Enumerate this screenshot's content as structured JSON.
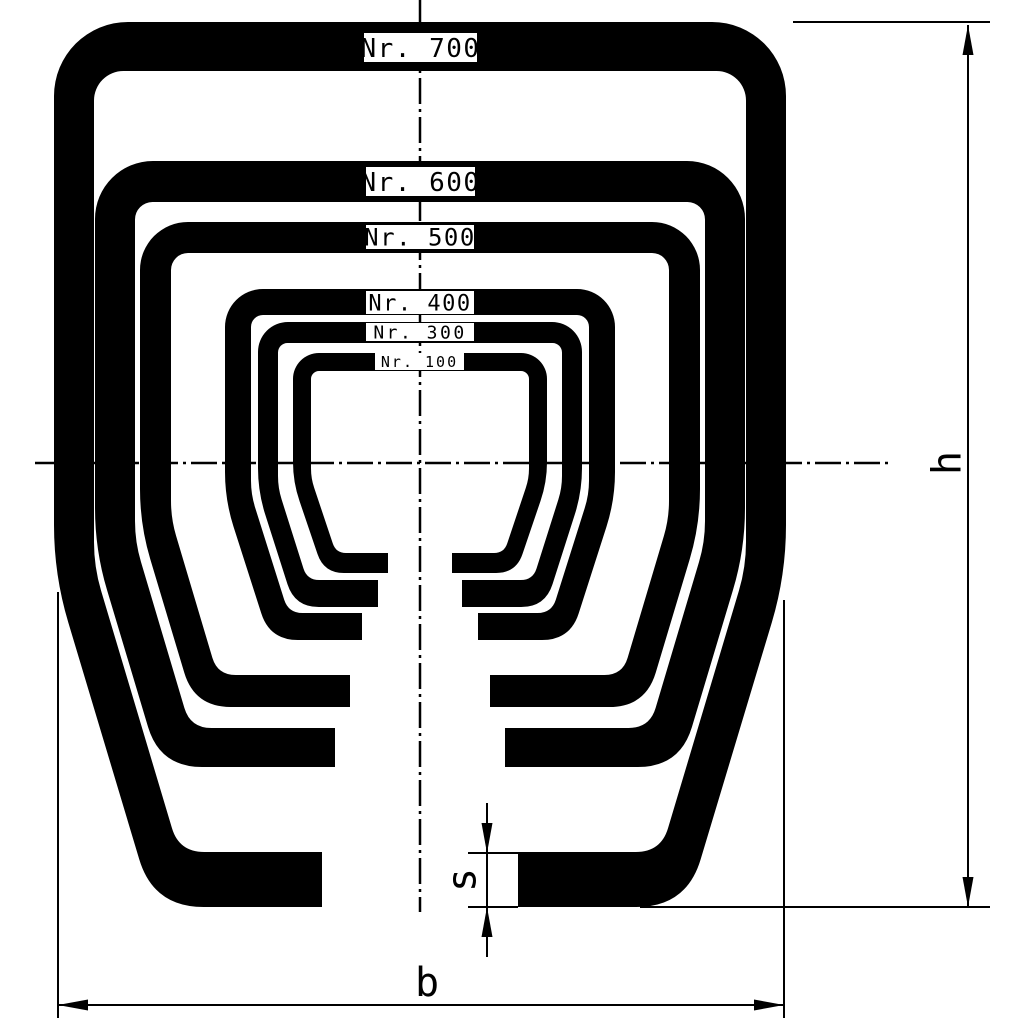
{
  "drawing": {
    "kind": "technical-cross-section",
    "description": "Nested C-rail profile cross sections"
  },
  "colors": {
    "ink": "#000000",
    "background": "#ffffff"
  },
  "geometry": {
    "centerX": 420,
    "dashPattern": "26 5 3 5",
    "centerlines": {
      "vertical": {
        "x": 420,
        "y1": 0,
        "y2": 912
      },
      "horizontal": {
        "y": 463,
        "x1": 35,
        "x2": 893
      }
    }
  },
  "profiles": [
    {
      "id": "700",
      "label": "Nr. 700",
      "yTop": 22,
      "tTop": 49,
      "halfWidth": 366,
      "tSide": 40,
      "yShoulder": 575,
      "yBottom": 907,
      "tFlange": 55,
      "flangeEndX": 322,
      "slope": 0.3,
      "rTop": 74,
      "rBottom": 50,
      "box": {
        "x": 364,
        "y": 33,
        "w": 113,
        "h": 29
      },
      "fontSize": 26,
      "letterSpacing": 1.5
    },
    {
      "id": "600",
      "label": "Nr. 600",
      "yTop": 161,
      "tTop": 41,
      "halfWidth": 325,
      "tSide": 40,
      "yShoulder": 550,
      "yBottom": 767,
      "tFlange": 39,
      "flangeEndX": 335,
      "slope": 0.3,
      "rTop": 58,
      "rBottom": 42,
      "box": {
        "x": 366,
        "y": 167,
        "w": 109,
        "h": 29
      },
      "fontSize": 26,
      "letterSpacing": 1.5
    },
    {
      "id": "500",
      "label": "Nr. 500",
      "yTop": 222,
      "tTop": 31,
      "halfWidth": 280,
      "tSide": 31,
      "yShoulder": 525,
      "yBottom": 707,
      "tFlange": 32,
      "flangeEndX": 350,
      "slope": 0.3,
      "rTop": 48,
      "rBottom": 36,
      "box": {
        "x": 366,
        "y": 225,
        "w": 108,
        "h": 24
      },
      "fontSize": 24,
      "letterSpacing": 1.5
    },
    {
      "id": "400",
      "label": "Nr. 400",
      "yTop": 289,
      "tTop": 26,
      "halfWidth": 195,
      "tSide": 26,
      "yShoulder": 500,
      "yBottom": 640,
      "tFlange": 27,
      "flangeEndX": 362,
      "slope": 0.32,
      "rTop": 38,
      "rBottom": 28,
      "box": {
        "x": 366,
        "y": 291,
        "w": 108,
        "h": 23
      },
      "fontSize": 22,
      "letterSpacing": 1.5
    },
    {
      "id": "300",
      "label": "Nr. 300",
      "yTop": 322,
      "tTop": 21,
      "halfWidth": 162,
      "tSide": 20,
      "yShoulder": 492,
      "yBottom": 607,
      "tFlange": 27,
      "flangeEndX": 378,
      "slope": 0.32,
      "rTop": 30,
      "rBottom": 24,
      "box": {
        "x": 366,
        "y": 323,
        "w": 108,
        "h": 18
      },
      "fontSize": 18,
      "letterSpacing": 2.5
    },
    {
      "id": "100",
      "label": "Nr. 100",
      "yTop": 353,
      "tTop": 18,
      "halfWidth": 127,
      "tSide": 18,
      "yShoulder": 482,
      "yBottom": 573,
      "tFlange": 20,
      "flangeEndX": 388,
      "slope": 0.34,
      "rTop": 26,
      "rBottom": 20,
      "box": {
        "x": 375,
        "y": 353,
        "w": 89,
        "h": 17
      },
      "fontSize": 15,
      "letterSpacing": 2
    }
  ],
  "dimensions": {
    "h": {
      "label": "h",
      "lineX": 968,
      "yTip1": 25,
      "yTip2": 907,
      "extTop": {
        "x1": 793,
        "x2": 990,
        "y": 22
      },
      "extBottom": {
        "x1": 640,
        "x2": 990,
        "y": 907
      },
      "labelX": 946,
      "labelY": 463,
      "fontSize": 40
    },
    "b": {
      "label": "b",
      "lineY": 1005,
      "xTip1": 58,
      "xTip2": 784,
      "extLeft": {
        "x": 58,
        "y1": 592,
        "y2": 1018
      },
      "extRight": {
        "x": 784,
        "y1": 600,
        "y2": 1018
      },
      "labelX": 427,
      "labelY": 996,
      "fontSize": 40
    },
    "s": {
      "label": "s",
      "lineX": 487,
      "tickY1": 853,
      "tickY2": 907,
      "tickX1": 468,
      "tickX2": 518,
      "vertY1": 803,
      "vertY2": 957,
      "labelX": 461,
      "labelY": 880,
      "fontSize": 40
    }
  }
}
